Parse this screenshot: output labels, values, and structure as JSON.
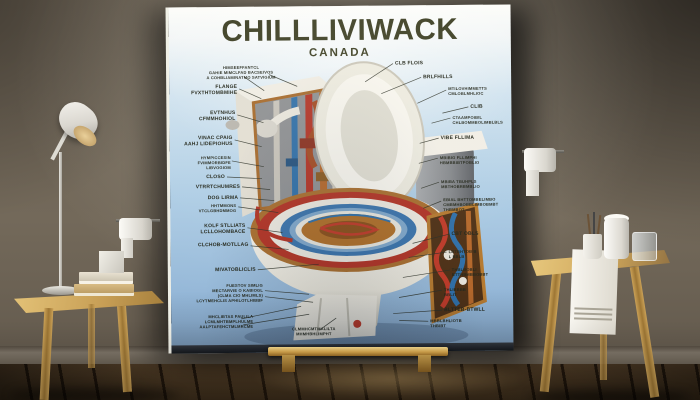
{
  "poster": {
    "title": "CHILLLIVIWACK",
    "subtitle": "CANADA",
    "labels_left": [
      {
        "text": "HIMSEEFFANTCL\nGAHIE MIMCLFAD BACSEIVOS\nA COHBLIAMINATMO SATVIGIUM"
      },
      {
        "text": "FLANGE\nFVXTHTOMBMIHE"
      },
      {
        "text": "EVTNHUS\nCFMMHOHIOL"
      },
      {
        "text": "VINAC CPAIG\nAAHJ LIDEPIOHUS"
      },
      {
        "text": "HYMPICCESIN\nFVIMMORBIDFE\nLIBVOGIOM"
      },
      {
        "text": "CLOSO"
      },
      {
        "text": "VTRRTCHUMRES"
      },
      {
        "text": "DOG LIRMA"
      },
      {
        "text": "HHTMMONS\nVTCLGBHDMMOG"
      },
      {
        "text": "KOLF STLLIATS\nLCLLOHOMBACE"
      },
      {
        "text": "CLCHOB-MOTLLAG"
      },
      {
        "text": "MIVATOBLICLIS"
      },
      {
        "text": "FUESTOV SIMLIG\nMECTARVIE O KABIOGL\n(CLMA CIO MHLIMLS)\nLCYTMEHCLIS APHILOTLHIBBF"
      },
      {
        "text": "MHCLIBTAS PAULILA\nLCMLMHTBMPLHULME\nAALPTAFEHCTMLMRCME"
      },
      {
        "text": "CLMMHCMTMALILTA\nMHMHBHLIMPHT"
      }
    ],
    "labels_right": [
      {
        "text": "CLB FLOIS"
      },
      {
        "text": "BRLFHILLS"
      },
      {
        "text": "MTILOVHIMMETTS\nCMLOBLMHLIOC"
      },
      {
        "text": "CLIB"
      },
      {
        "text": "CTAAMPOIBIL\nCHLBOMMBOLIMBLBLS"
      },
      {
        "text": "VIBE FLLIMA"
      },
      {
        "text": "MBIBIG FLLIMPHI\nHBMBBIBTPOBLIO"
      },
      {
        "text": "MBIBA TBUHPLS\nMBTHOBRBMBLIO"
      },
      {
        "text": "EBIAL BHTTOMBELIMBO\nCMBMHBOBBLIMBOBMBT\nTHBMBOT"
      },
      {
        "text": "CBT OBLS"
      },
      {
        "text": "LBTBHTOB B\nL BBLB"
      },
      {
        "text": "THBLBOBLI\nBTTHBMBBOBBT"
      },
      {
        "text": "THLIBBBB\nBBLIT"
      },
      {
        "text": "BLTTEB-BTWLL"
      },
      {
        "text": "MBBLBHLIOTB\nTHBIBT"
      }
    ]
  },
  "colors": {
    "poster_blue": "#a9c9e4",
    "title_ink": "#3b3d22",
    "wall": "#6f6557",
    "floor_wood": "#46331f",
    "furniture_wood": "#c9a05a",
    "pipe_red": "#b23325",
    "pipe_blue": "#2f6fa8",
    "pipe_copper": "#b4672a",
    "bowl_water_amber": "#b06f28",
    "easel_gold": "#d9a84e"
  }
}
